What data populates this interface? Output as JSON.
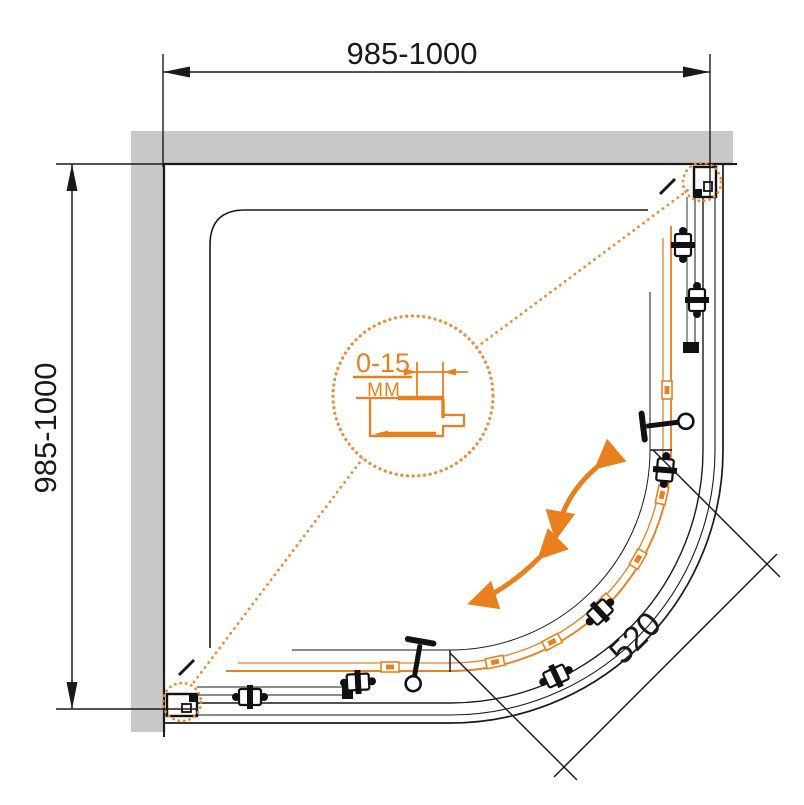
{
  "drawing": {
    "subject": "Quadrant shower enclosure plan-view technical drawing",
    "dimensions": {
      "top": "985-1000",
      "left": "985-1000",
      "diagonal": "520"
    },
    "detail": {
      "value": "0-15",
      "unit": "MM"
    }
  },
  "colors": {
    "accent_orange": "#E8801E",
    "dot_orange": "#ED8A35",
    "wall_gray": "#C8C8C8",
    "line_black": "#1A1A1A"
  }
}
